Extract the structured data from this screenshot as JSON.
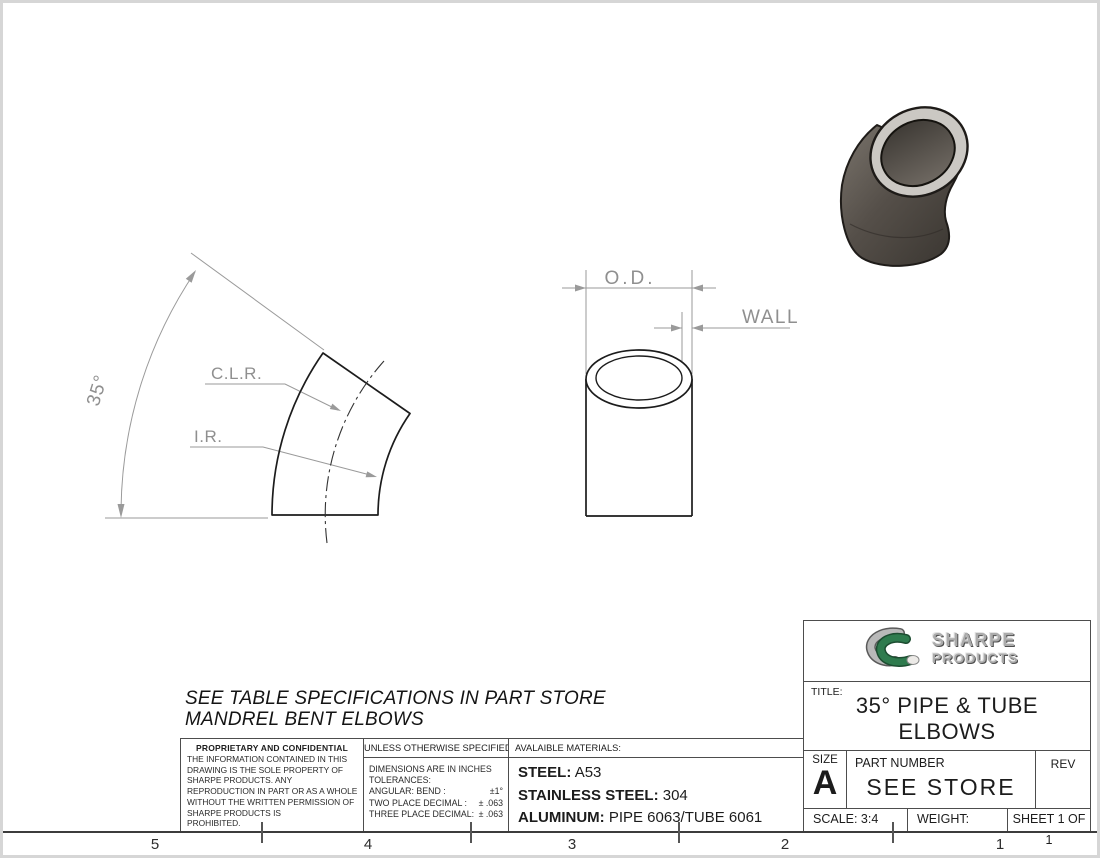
{
  "drawing": {
    "note": {
      "line1": "SEE TABLE SPECIFICATIONS IN PART STORE",
      "line2": "MANDREL BENT ELBOWS"
    },
    "labels": {
      "angle": "35°",
      "clr": "C.L.R.",
      "ir": "I.R.",
      "od": "O.D.",
      "wall": "WALL"
    },
    "zones": [
      "5",
      "4",
      "3",
      "2",
      "1"
    ]
  },
  "proprietary": {
    "title": "PROPRIETARY AND CONFIDENTIAL",
    "lines": [
      "THE INFORMATION CONTAINED IN THIS",
      "DRAWING IS THE SOLE PROPERTY OF",
      "SHARPE PRODUCTS.  ANY",
      "REPRODUCTION IN PART OR AS A WHOLE",
      "WITHOUT THE WRITTEN PERMISSION OF",
      "SHARPE PRODUCTS IS",
      "PROHIBITED."
    ]
  },
  "tolerances": {
    "header": "UNLESS OTHERWISE SPECIFIED:",
    "intro1": "DIMENSIONS ARE IN INCHES",
    "intro2": "TOLERANCES:",
    "rows": [
      {
        "label": "ANGULAR: BEND :",
        "value": "±1°"
      },
      {
        "label": "TWO PLACE DECIMAL :",
        "value": "± .063"
      },
      {
        "label": "THREE PLACE DECIMAL:",
        "value": "± .063"
      }
    ]
  },
  "materials": {
    "header": "AVALAIBLE MATERIALS:",
    "items": [
      {
        "label": "STEEL:",
        "value": "A53"
      },
      {
        "label": "STAINLESS STEEL:",
        "value": "304"
      },
      {
        "label": "ALUMINUM:",
        "value": "PIPE 6063/TUBE 6061"
      }
    ]
  },
  "title_block": {
    "brand_top": "SHARPE",
    "brand_bottom": "PRODUCTS",
    "title_label": "TITLE:",
    "title_line1": "35° PIPE & TUBE",
    "title_line2": "ELBOWS",
    "size_label": "SIZE",
    "size_value": "A",
    "part_label": "PART NUMBER",
    "part_value": "SEE STORE",
    "rev_label": "REV",
    "scale_text": "SCALE: 3:4",
    "weight_label": "WEIGHT:",
    "sheet_text": "SHEET 1 OF 1"
  },
  "colors": {
    "line_dark": "#1c1c1c",
    "dim_gray": "#8f8f8f",
    "brand_green": "#2f7b4e",
    "body_dark": "#4a453f",
    "rim_gray": "#cbc8c3"
  }
}
